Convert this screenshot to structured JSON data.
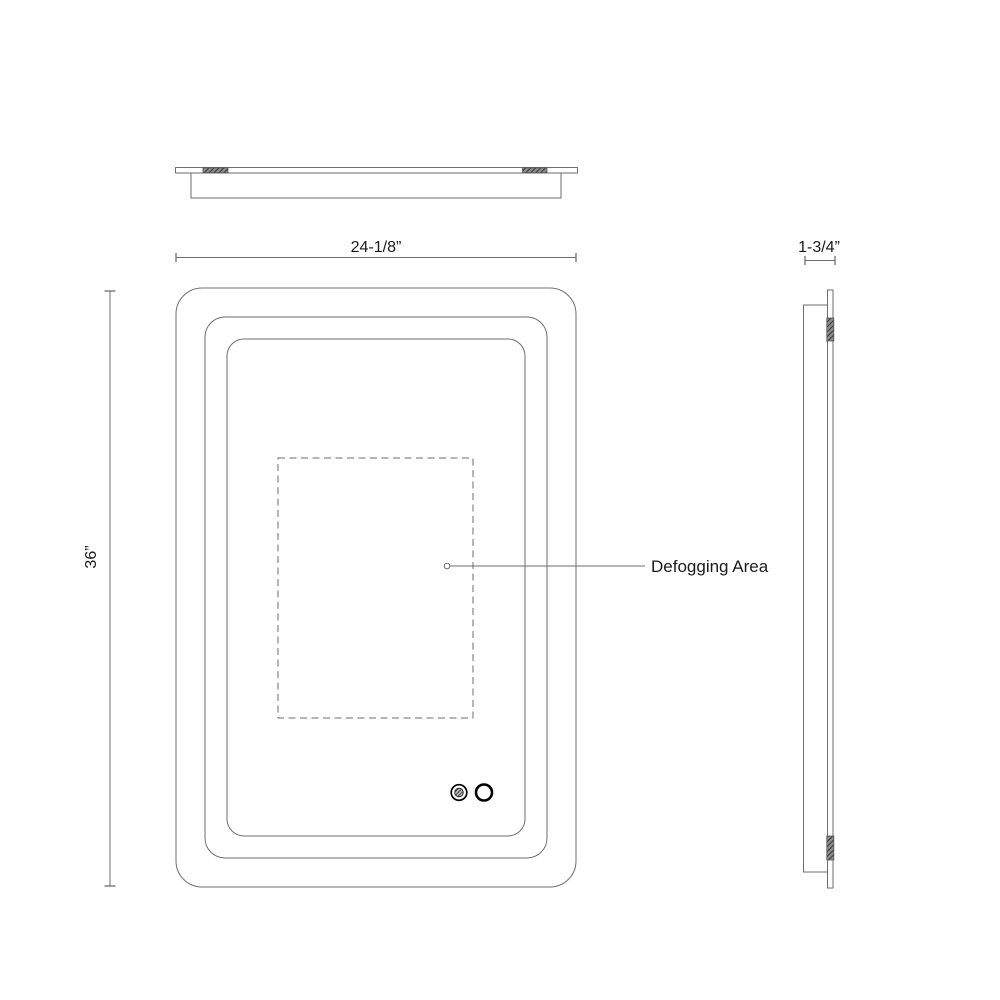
{
  "dimensions": {
    "width": "24-1/8”",
    "height": "36”",
    "depth": "1-3/4”"
  },
  "labels": {
    "defogging_area": "Defogging Area"
  },
  "icons": {
    "defogger_button": "textured-circle-defogger",
    "power_button": "open-circle-power"
  },
  "colors": {
    "line": "#6e6e6e",
    "text": "#1a1a1a",
    "button": "#000000",
    "background": "#ffffff"
  }
}
